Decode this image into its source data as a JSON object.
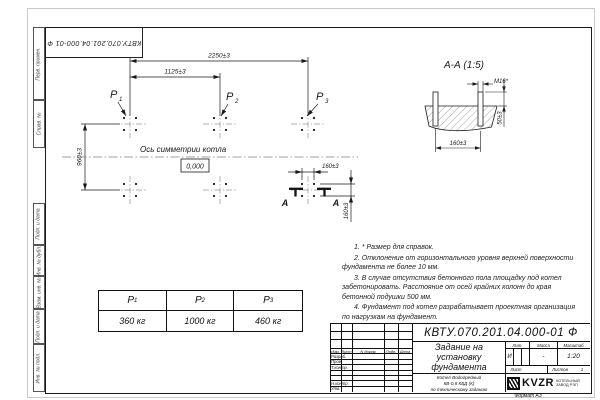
{
  "sheet": {
    "doc_number_rotated": "КВТУ.070.201.04.000-01 Ф",
    "format_label": "Формат А3",
    "side_labels": {
      "perv": "Перв. примен.",
      "sprav": "Справ. №",
      "podp1": "Подп. и дата",
      "inv_dubl": "Инв. № дубл.",
      "vzam": "Взам. инв. №",
      "podp2": "Подп. и дата",
      "inv_podl": "Инв. № подл."
    }
  },
  "plan": {
    "dim_overall": "2250±3",
    "dim_half": "1125±3",
    "dim_rows": "960±3",
    "dim_bolt_h": "160±3",
    "dim_bolt_v": "160±3",
    "axis_label": "Ось симметрии котла",
    "level": "0,000",
    "p1": "P",
    "p1_sub": "1",
    "p2": "P",
    "p2_sub": "2",
    "p3": "P",
    "p3_sub": "3",
    "section_letter_left": "А",
    "section_letter_right": "А"
  },
  "section": {
    "title": "А-А (1:5)",
    "thread_label": "М16*",
    "dim_height": "50±3",
    "dim_spacing": "160±3"
  },
  "notes": [
    "1. * Размер для справок.",
    "2. Отклонение от горизонтального уровня верхней поверхности фундамента не более 10 мм.",
    "3. В случае отсутствия бетонного пола площадку под котел забетонировать. Расстояние от осей крайних колонн до края бетонной подушки 500 мм.",
    "4. Фундамент под котел разрабатывает проектная организация по нагрузкам на фундамент."
  ],
  "load_table": {
    "headers": [
      {
        "label": "P",
        "sub": "1"
      },
      {
        "label": "P",
        "sub": "2"
      },
      {
        "label": "P",
        "sub": "3"
      }
    ],
    "values": [
      "360 кг",
      "1000 кг",
      "460 кг"
    ]
  },
  "title_block": {
    "doc_number": "КВТУ.070.201.04.000-01 Ф",
    "title_line1": "Задание на",
    "title_line2": "установку",
    "title_line3": "фундамента",
    "product_line1": "Котел Водогрейный",
    "product_line2": "КВ-0,8 КБД (К)",
    "product_line3": "по техническому заданию",
    "col_izm": "Изм.",
    "col_list": "Лист",
    "col_ndoc": "N докум.",
    "col_podp": "Подп.",
    "col_data": "Дата",
    "row_razrab": "Разраб.",
    "row_prov": "Пров.",
    "row_tkontr": "Т.контр.",
    "row_nkontr": "Н.контр.",
    "row_utv": "Утв.",
    "lit_header": "Лит.",
    "mass_header": "Масса",
    "scale_header": "Масштаб",
    "lit_value": "И",
    "mass_value": "-",
    "scale_value": "1:20",
    "sheet_label": "Лист",
    "sheets_label": "Листов",
    "sheets_value": "1",
    "logo_text": "KVZR",
    "logo_caption1": "КОТЕЛЬНЫЙ",
    "logo_caption2": "ЗАВОД РЭП"
  }
}
